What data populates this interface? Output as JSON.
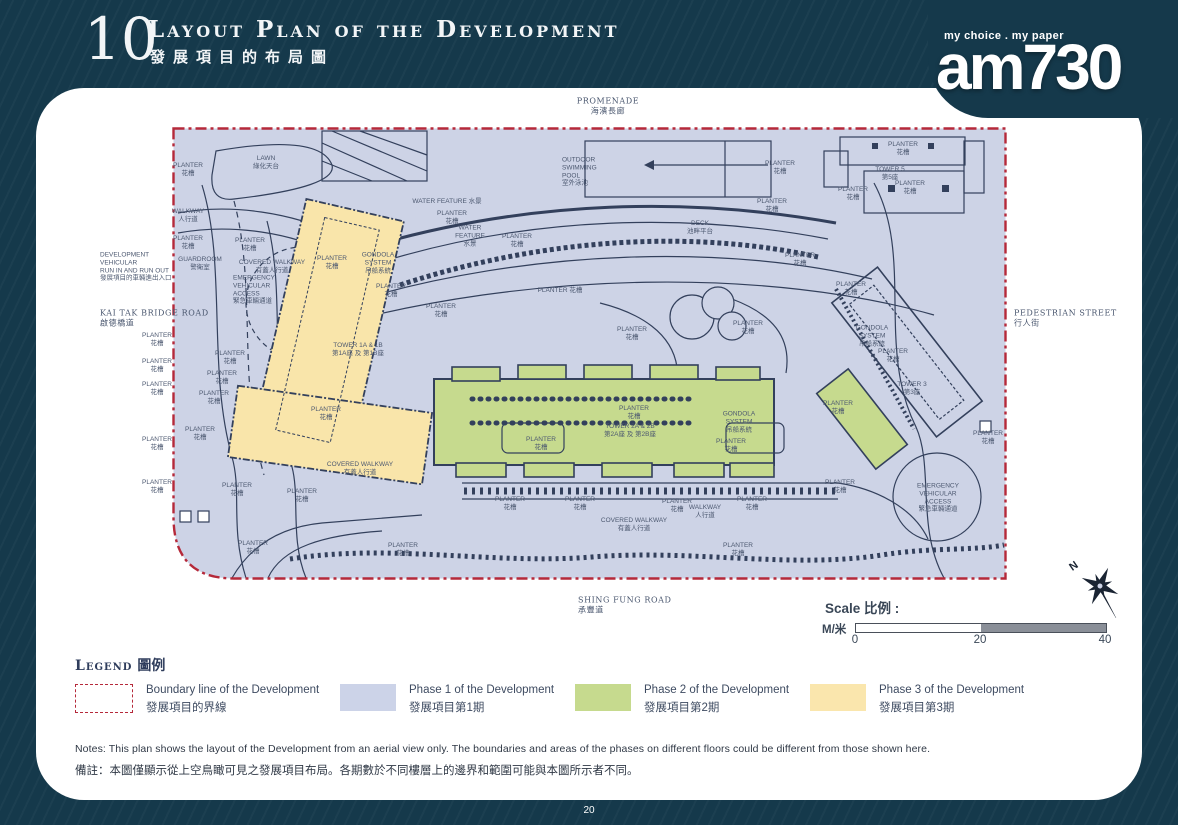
{
  "header": {
    "section_number": "10",
    "title_en": "Layout Plan of the Development",
    "title_zh": "發展項目的布局圖"
  },
  "logo": {
    "tagline": "my choice . my paper",
    "name": "am730"
  },
  "plan": {
    "labels": [
      {
        "x": 608,
        "y": 106,
        "a": "c",
        "k": "road",
        "t": [
          "PROMENADE",
          "海濱長廊"
        ]
      },
      {
        "x": 100,
        "y": 318,
        "a": "l",
        "k": "road",
        "t": [
          "KAI TAK BRIDGE ROAD",
          "啟德橋道"
        ]
      },
      {
        "x": 1014,
        "y": 318,
        "a": "l",
        "k": "road",
        "t": [
          "PEDESTRIAN STREET",
          "行人街"
        ]
      },
      {
        "x": 578,
        "y": 605,
        "a": "l",
        "k": "road",
        "t": [
          "SHING FUNG ROAD",
          "承豐道"
        ]
      },
      {
        "x": 100,
        "y": 267,
        "a": "l",
        "t": [
          "DEVELOPMENT",
          "VEHICULAR",
          "RUN IN AND RUN OUT",
          "發展項目的車輛進出入口"
        ]
      },
      {
        "x": 157,
        "y": 340,
        "a": "c",
        "t": [
          "PLANTER",
          "花槽"
        ]
      },
      {
        "x": 157,
        "y": 366,
        "a": "c",
        "t": [
          "PLANTER",
          "花槽"
        ]
      },
      {
        "x": 157,
        "y": 389,
        "a": "c",
        "t": [
          "PLANTER",
          "花槽"
        ]
      },
      {
        "x": 157,
        "y": 444,
        "a": "c",
        "t": [
          "PLANTER",
          "花槽"
        ]
      },
      {
        "x": 157,
        "y": 487,
        "a": "c",
        "t": [
          "PLANTER",
          "花槽"
        ]
      },
      {
        "x": 188,
        "y": 170,
        "a": "c",
        "t": [
          "PLANTER",
          "花槽"
        ]
      },
      {
        "x": 266,
        "y": 163,
        "a": "c",
        "t": [
          "LAWN",
          "綠化天台"
        ]
      },
      {
        "x": 188,
        "y": 216,
        "a": "c",
        "t": [
          "WALKWAY",
          "人行道"
        ]
      },
      {
        "x": 188,
        "y": 243,
        "a": "c",
        "t": [
          "PLANTER",
          "花槽"
        ]
      },
      {
        "x": 250,
        "y": 245,
        "a": "c",
        "t": [
          "PLANTER",
          "花槽"
        ]
      },
      {
        "x": 200,
        "y": 264,
        "a": "c",
        "t": [
          "GUARDROOM",
          "警衛室"
        ]
      },
      {
        "x": 272,
        "y": 267,
        "a": "c",
        "t": [
          "COVERED WALKWAY",
          "有蓋人行道"
        ]
      },
      {
        "x": 233,
        "y": 290,
        "a": "l",
        "t": [
          "EMERGENCY",
          "VEHICULAR",
          "ACCESS",
          "緊急車輛通道"
        ]
      },
      {
        "x": 447,
        "y": 202,
        "a": "c",
        "t": [
          "WATER FEATURE 水景"
        ]
      },
      {
        "x": 452,
        "y": 218,
        "a": "c",
        "t": [
          "PLANTER",
          "花槽"
        ]
      },
      {
        "x": 470,
        "y": 236,
        "a": "c",
        "t": [
          "WATER",
          "FEATURE",
          "水景"
        ]
      },
      {
        "x": 517,
        "y": 241,
        "a": "c",
        "t": [
          "PLANTER",
          "花槽"
        ]
      },
      {
        "x": 700,
        "y": 228,
        "a": "c",
        "t": [
          "DECK",
          "池畔平台"
        ]
      },
      {
        "x": 562,
        "y": 172,
        "a": "l",
        "t": [
          "OUTDOOR",
          "SWIMMING",
          "POOL",
          "室外泳池"
        ]
      },
      {
        "x": 780,
        "y": 168,
        "a": "c",
        "t": [
          "PLANTER",
          "花槽"
        ]
      },
      {
        "x": 772,
        "y": 206,
        "a": "c",
        "t": [
          "PLANTER",
          "花槽"
        ]
      },
      {
        "x": 560,
        "y": 291,
        "a": "c",
        "t": [
          "PLANTER 花槽"
        ]
      },
      {
        "x": 632,
        "y": 334,
        "a": "c",
        "t": [
          "PLANTER",
          "花槽"
        ]
      },
      {
        "x": 748,
        "y": 328,
        "a": "c",
        "t": [
          "PLANTER",
          "花槽"
        ]
      },
      {
        "x": 800,
        "y": 260,
        "a": "c",
        "t": [
          "PLANTER",
          "花槽"
        ]
      },
      {
        "x": 332,
        "y": 263,
        "a": "c",
        "t": [
          "PLANTER",
          "花槽"
        ]
      },
      {
        "x": 378,
        "y": 263,
        "a": "c",
        "t": [
          "GONDOLA",
          "SYSTEM",
          "吊船系統"
        ]
      },
      {
        "x": 391,
        "y": 291,
        "a": "c",
        "t": [
          "PLANTER",
          "花槽"
        ]
      },
      {
        "x": 441,
        "y": 311,
        "a": "c",
        "t": [
          "PLANTER",
          "花槽"
        ]
      },
      {
        "x": 358,
        "y": 350,
        "a": "c",
        "t": [
          "TOWER 1A & 1B",
          "第1A座 及 第1B座"
        ]
      },
      {
        "x": 326,
        "y": 414,
        "a": "c",
        "t": [
          "PLANTER",
          "花槽"
        ]
      },
      {
        "x": 230,
        "y": 358,
        "a": "c",
        "t": [
          "PLANTER",
          "花槽"
        ]
      },
      {
        "x": 222,
        "y": 378,
        "a": "c",
        "t": [
          "PLANTER",
          "花槽"
        ]
      },
      {
        "x": 214,
        "y": 398,
        "a": "c",
        "t": [
          "PLANTER",
          "花槽"
        ]
      },
      {
        "x": 200,
        "y": 434,
        "a": "c",
        "t": [
          "PLANTER",
          "花槽"
        ]
      },
      {
        "x": 237,
        "y": 490,
        "a": "c",
        "t": [
          "PLANTER",
          "花槽"
        ]
      },
      {
        "x": 302,
        "y": 496,
        "a": "c",
        "t": [
          "PLANTER",
          "花槽"
        ]
      },
      {
        "x": 360,
        "y": 469,
        "a": "c",
        "t": [
          "COVERED WALKWAY",
          "有蓋人行道"
        ]
      },
      {
        "x": 541,
        "y": 444,
        "a": "c",
        "t": [
          "PLANTER",
          "花槽"
        ]
      },
      {
        "x": 634,
        "y": 413,
        "a": "c",
        "t": [
          "PLANTER",
          "花槽"
        ]
      },
      {
        "x": 630,
        "y": 431,
        "a": "c",
        "t": [
          "TOWER 2A & 2B",
          "第2A座 及 第2B座"
        ]
      },
      {
        "x": 739,
        "y": 422,
        "a": "c",
        "t": [
          "GONDOLA",
          "SYSTEM",
          "吊船系統"
        ]
      },
      {
        "x": 731,
        "y": 446,
        "a": "c",
        "t": [
          "PLANTER",
          "花槽"
        ]
      },
      {
        "x": 510,
        "y": 504,
        "a": "c",
        "t": [
          "PLANTER",
          "花槽"
        ]
      },
      {
        "x": 580,
        "y": 504,
        "a": "c",
        "t": [
          "PLANTER",
          "花槽"
        ]
      },
      {
        "x": 677,
        "y": 506,
        "a": "c",
        "t": [
          "PLANTER",
          "花槽"
        ]
      },
      {
        "x": 705,
        "y": 512,
        "a": "c",
        "t": [
          "WALKWAY",
          "人行道"
        ]
      },
      {
        "x": 752,
        "y": 504,
        "a": "c",
        "t": [
          "PLANTER",
          "花槽"
        ]
      },
      {
        "x": 634,
        "y": 525,
        "a": "c",
        "t": [
          "COVERED WALKWAY",
          "有蓋人行道"
        ]
      },
      {
        "x": 738,
        "y": 550,
        "a": "c",
        "t": [
          "PLANTER",
          "花槽"
        ]
      },
      {
        "x": 253,
        "y": 548,
        "a": "c",
        "t": [
          "PLANTER",
          "花槽"
        ]
      },
      {
        "x": 403,
        "y": 550,
        "a": "c",
        "t": [
          "PLANTER",
          "花槽"
        ]
      },
      {
        "x": 903,
        "y": 149,
        "a": "c",
        "t": [
          "PLANTER",
          "花槽"
        ]
      },
      {
        "x": 890,
        "y": 174,
        "a": "c",
        "t": [
          "TOWER 5",
          "第5座"
        ]
      },
      {
        "x": 853,
        "y": 194,
        "a": "c",
        "t": [
          "PLANTER",
          "花槽"
        ]
      },
      {
        "x": 910,
        "y": 188,
        "a": "c",
        "t": [
          "PLANTER",
          "花槽"
        ]
      },
      {
        "x": 851,
        "y": 289,
        "a": "c",
        "t": [
          "PLANTER",
          "花槽"
        ]
      },
      {
        "x": 872,
        "y": 336,
        "a": "c",
        "t": [
          "GONDOLA",
          "SYSTEM",
          "吊船系統"
        ]
      },
      {
        "x": 893,
        "y": 356,
        "a": "c",
        "t": [
          "PLANTER",
          "花槽"
        ]
      },
      {
        "x": 912,
        "y": 389,
        "a": "c",
        "t": [
          "TOWER 3",
          "第3座"
        ]
      },
      {
        "x": 838,
        "y": 408,
        "a": "c",
        "t": [
          "PLANTER",
          "花槽"
        ]
      },
      {
        "x": 938,
        "y": 498,
        "a": "c",
        "t": [
          "EMERGENCY",
          "VEHICULAR",
          "ACCESS",
          "緊急車輛通道"
        ]
      },
      {
        "x": 988,
        "y": 438,
        "a": "c",
        "t": [
          "PLANTER",
          "花槽"
        ]
      },
      {
        "x": 840,
        "y": 487,
        "a": "c",
        "t": [
          "PLANTER",
          "花槽"
        ]
      }
    ]
  },
  "scale": {
    "title": "Scale 比例 :",
    "unit": "M/米",
    "ticks": [
      "0",
      "20",
      "40"
    ]
  },
  "legend": {
    "title_en": "Legend",
    "title_zh": "圖例",
    "items": [
      {
        "en": "Boundary line of the Development",
        "zh": "發展項目的界線",
        "color": "#B5293A"
      },
      {
        "en": "Phase 1 of the Development",
        "zh": "發展項目第1期",
        "color": "#CCD3E8"
      },
      {
        "en": "Phase 2 of the Development",
        "zh": "發展項目第2期",
        "color": "#C6DA8E"
      },
      {
        "en": "Phase 3 of the Development",
        "zh": "發展項目第3期",
        "color": "#FAE6AD"
      }
    ]
  },
  "notes": {
    "en": "Notes:  This plan shows the layout of the Development from an aerial view only. The boundaries and areas of the phases on different floors could be different from those shown here.",
    "zh": "備註：本圖僅顯示從上空鳥瞰可見之發展項目布局。各期數於不同樓層上的邊界和範圍可能與本圖所示者不同。"
  },
  "footer": {
    "page_number": "20"
  }
}
